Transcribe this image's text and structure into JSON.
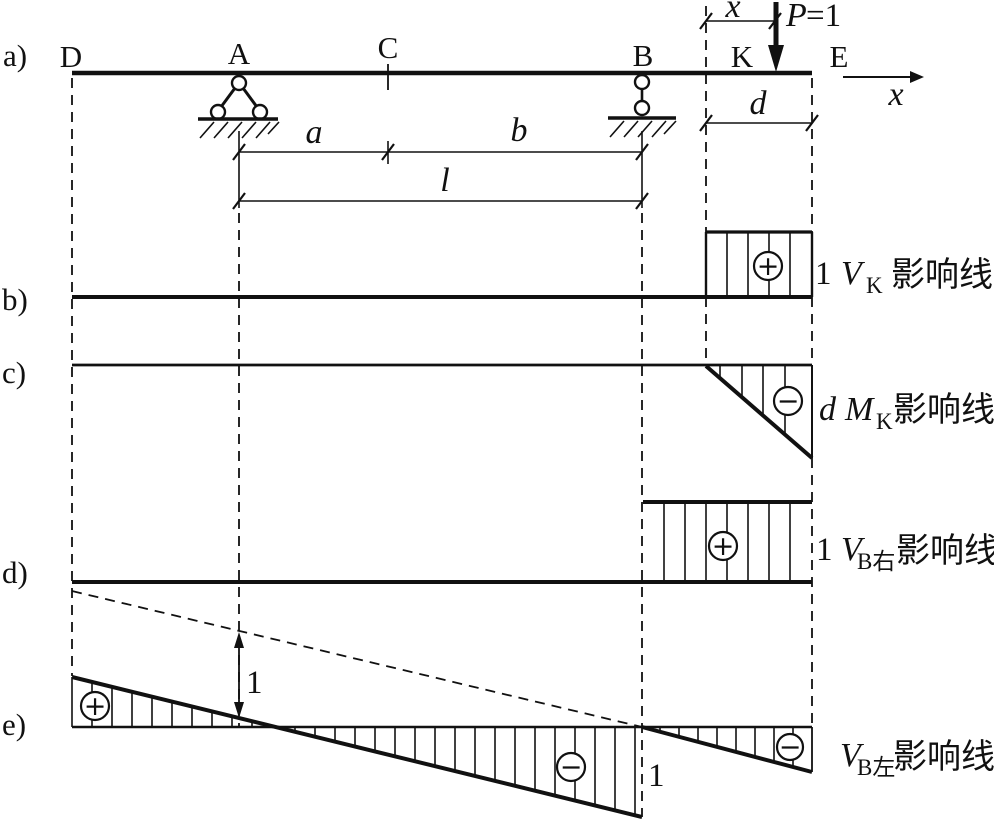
{
  "labels": {
    "panel_a": "a)",
    "panel_b": "b)",
    "panel_c": "c)",
    "panel_d": "d)",
    "panel_e": "e)"
  },
  "beam": {
    "D": "D",
    "A": "A",
    "C": "C",
    "B": "B",
    "K": "K",
    "E": "E",
    "load_p": "P",
    "load_val": "=1",
    "dim_x": "x",
    "axis_x": "x",
    "dim_a": "a",
    "dim_b": "b",
    "dim_l": "l",
    "dim_d": "d"
  },
  "il": {
    "vk": {
      "ordinate": "1",
      "sym": "V",
      "sub": "K",
      "text": "影响线",
      "sign": "+"
    },
    "mk": {
      "ordinate": "d",
      "sym": "M",
      "sub": "K",
      "text": "影响线",
      "sign": "−"
    },
    "vbr": {
      "ordinate": "1",
      "sym": "V",
      "sub": "B右",
      "text": "影响线",
      "sign": "+"
    },
    "vbl": {
      "sym": "V",
      "sub": "B左",
      "text": "影响线",
      "dim_one": "1",
      "ordinate_b": "1",
      "sign_pos": "+",
      "sign_neg_mid": "−",
      "sign_neg_right": "−"
    }
  },
  "colors": {
    "ink": "#111111",
    "background": "#ffffff"
  }
}
